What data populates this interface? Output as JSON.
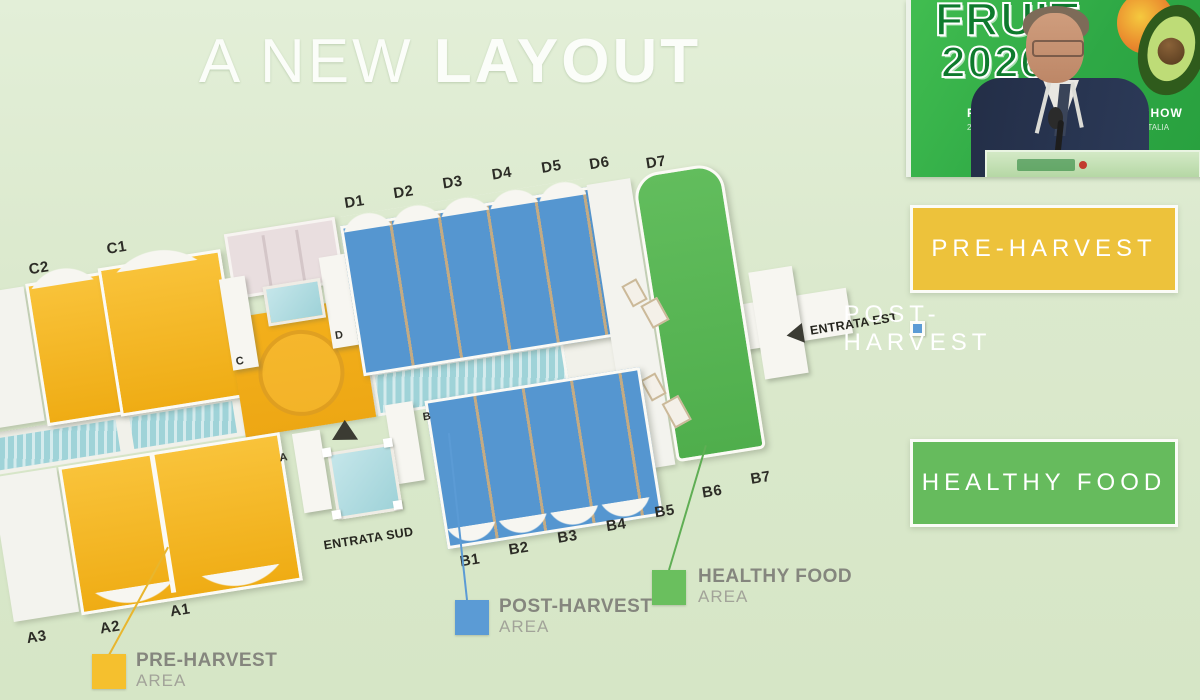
{
  "slide": {
    "title_regular": "A NEW",
    "title_bold": "LAYOUT"
  },
  "video_overlay": {
    "logo": {
      "line1": "FRUIT",
      "line2": "2026"
    },
    "backdrop_fragments": {
      "left_top": "FRU",
      "right_top": "L SHOW",
      "left_bottom": "21-22-",
      "right_bottom": "RE · ITALIA"
    }
  },
  "legend_panels": [
    {
      "label": "PRE-HARVEST",
      "color": "#edc23b"
    },
    {
      "label": "POST-HARVEST",
      "color": "#5b9bd5"
    },
    {
      "label": "HEALTHY FOOD",
      "color": "#66bb5d"
    }
  ],
  "map": {
    "top_labels": [
      "D1",
      "D2",
      "D3",
      "D4",
      "D5",
      "D6",
      "D7"
    ],
    "left_labels": [
      "C2",
      "C1"
    ],
    "bottom_left_labels": [
      "A3",
      "A2",
      "A1"
    ],
    "bottom_labels": [
      "B1",
      "B2",
      "B3",
      "B4",
      "B5",
      "B6",
      "B7"
    ],
    "gate_labels": {
      "north_left": "C",
      "north_right": "D",
      "south_left": "A",
      "south_right": "B"
    },
    "entrance_south": "ENTRATA SUD",
    "entrance_east": "ENTRATA EST",
    "area_colors": {
      "pre_harvest": "#f2b722",
      "post_harvest": "#5596d0",
      "healthy_food": "#5cb757",
      "water": "#9fd3d8"
    }
  },
  "area_callouts": [
    {
      "title": "PRE-HARVEST",
      "subtitle": "AREA",
      "color": "#f5c02e"
    },
    {
      "title": "POST-HARVEST",
      "subtitle": "AREA",
      "color": "#5b9bd5"
    },
    {
      "title": "HEALTHY FOOD",
      "subtitle": "AREA",
      "color": "#6abf5e"
    }
  ]
}
